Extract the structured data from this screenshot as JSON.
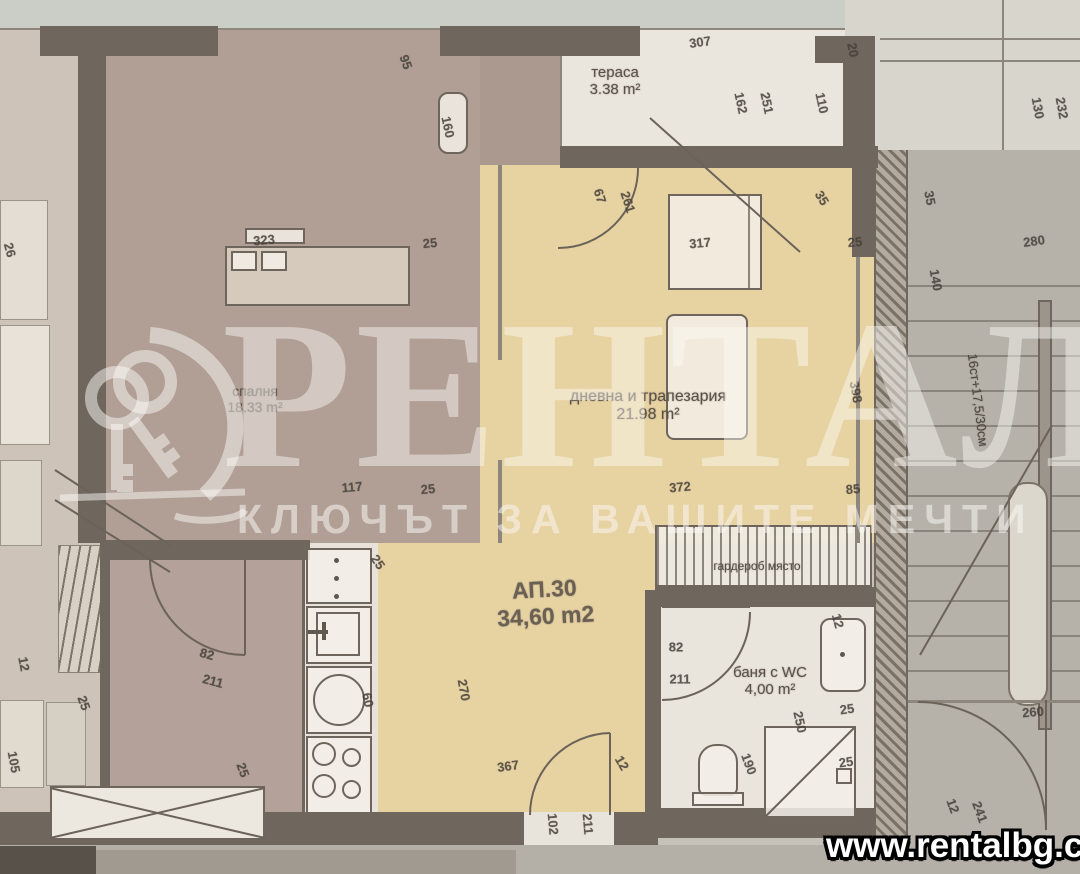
{
  "branding": {
    "brand": "РЕНТАЛ",
    "tagline": "КЛЮЧЪТ ЗА ВАШИТЕ МЕЧТИ",
    "website": "www.rentalbg.com",
    "logo": "keys-icon"
  },
  "apartment": {
    "label": "АП.30",
    "area": "34,60 m2"
  },
  "rooms": {
    "terrace": {
      "name": "тераса",
      "area": "3.38 m²"
    },
    "bedroom": {
      "name": "спалня",
      "area": "18.33 m²"
    },
    "living": {
      "name": "дневна и трапезария",
      "area": "21.98 m²"
    },
    "bath": {
      "name": "баня с WC",
      "area": "4,00 m²"
    },
    "wardrobe": {
      "name": "гардероб място"
    }
  },
  "stairs": {
    "note": "16ст+17,5/30см"
  },
  "colors": {
    "photo_bg": "#c6c2b9",
    "wall": "#6f675e",
    "bedroom_floor": "#b19f96",
    "living_floor": "#e7d2a2",
    "white_room": "#eae5dd",
    "stair_gray": "#b6b2aa",
    "dim_text": "#46403a",
    "watermark": "rgba(252,250,246,0.5)",
    "site_text": "#ffffff"
  },
  "dimensions": [
    {
      "t": "307",
      "x": 700,
      "y": 42,
      "r": -8
    },
    {
      "t": "20",
      "x": 853,
      "y": 50,
      "r": 80
    },
    {
      "t": "162",
      "x": 741,
      "y": 103,
      "r": 78
    },
    {
      "t": "251",
      "x": 767,
      "y": 103,
      "r": 78
    },
    {
      "t": "110",
      "x": 822,
      "y": 103,
      "r": 78
    },
    {
      "t": "130",
      "x": 1038,
      "y": 108,
      "r": 80
    },
    {
      "t": "232",
      "x": 1062,
      "y": 108,
      "r": 80
    },
    {
      "t": "95",
      "x": 406,
      "y": 62,
      "r": 70
    },
    {
      "t": "160",
      "x": 448,
      "y": 127,
      "r": 78
    },
    {
      "t": "26",
      "x": 10,
      "y": 250,
      "r": 75
    },
    {
      "t": "67",
      "x": 600,
      "y": 196,
      "r": 72
    },
    {
      "t": "261",
      "x": 628,
      "y": 202,
      "r": 72
    },
    {
      "t": "35",
      "x": 822,
      "y": 198,
      "r": 58
    },
    {
      "t": "35",
      "x": 930,
      "y": 198,
      "r": 80
    },
    {
      "t": "317",
      "x": 700,
      "y": 243,
      "r": -5
    },
    {
      "t": "25",
      "x": 855,
      "y": 242,
      "r": -5
    },
    {
      "t": "323",
      "x": 264,
      "y": 240,
      "r": -5
    },
    {
      "t": "25",
      "x": 430,
      "y": 243,
      "r": -5
    },
    {
      "t": "280",
      "x": 1034,
      "y": 241,
      "r": -8
    },
    {
      "t": "140",
      "x": 936,
      "y": 280,
      "r": 80
    },
    {
      "t": "398",
      "x": 856,
      "y": 392,
      "r": 80
    },
    {
      "t": "117",
      "x": 352,
      "y": 487,
      "r": -5
    },
    {
      "t": "25",
      "x": 428,
      "y": 489,
      "r": -5
    },
    {
      "t": "372",
      "x": 680,
      "y": 487,
      "r": -5
    },
    {
      "t": "85",
      "x": 853,
      "y": 489,
      "r": -5
    },
    {
      "t": "25",
      "x": 378,
      "y": 562,
      "r": 55
    },
    {
      "t": "60",
      "x": 368,
      "y": 700,
      "r": 80
    },
    {
      "t": "270",
      "x": 464,
      "y": 690,
      "r": 80
    },
    {
      "t": "82",
      "x": 207,
      "y": 654,
      "r": 15
    },
    {
      "t": "211",
      "x": 213,
      "y": 681,
      "r": 15
    },
    {
      "t": "12",
      "x": 24,
      "y": 664,
      "r": 80
    },
    {
      "t": "25",
      "x": 84,
      "y": 703,
      "r": 70
    },
    {
      "t": "105",
      "x": 14,
      "y": 762,
      "r": 80
    },
    {
      "t": "25",
      "x": 243,
      "y": 770,
      "r": 70
    },
    {
      "t": "82",
      "x": 676,
      "y": 647,
      "r": 0
    },
    {
      "t": "211",
      "x": 680,
      "y": 679,
      "r": 0
    },
    {
      "t": "12",
      "x": 838,
      "y": 621,
      "r": 75
    },
    {
      "t": "250",
      "x": 800,
      "y": 722,
      "r": 78
    },
    {
      "t": "25",
      "x": 847,
      "y": 709,
      "r": -8
    },
    {
      "t": "25",
      "x": 846,
      "y": 762,
      "r": -8
    },
    {
      "t": "190",
      "x": 749,
      "y": 764,
      "r": 70
    },
    {
      "t": "367",
      "x": 508,
      "y": 766,
      "r": -8
    },
    {
      "t": "12",
      "x": 622,
      "y": 763,
      "r": 60
    },
    {
      "t": "102",
      "x": 553,
      "y": 824,
      "r": 85
    },
    {
      "t": "211",
      "x": 588,
      "y": 824,
      "r": 85
    },
    {
      "t": "12",
      "x": 953,
      "y": 806,
      "r": 70
    },
    {
      "t": "241",
      "x": 980,
      "y": 812,
      "r": 70
    },
    {
      "t": "260",
      "x": 1033,
      "y": 712,
      "r": -5
    }
  ]
}
